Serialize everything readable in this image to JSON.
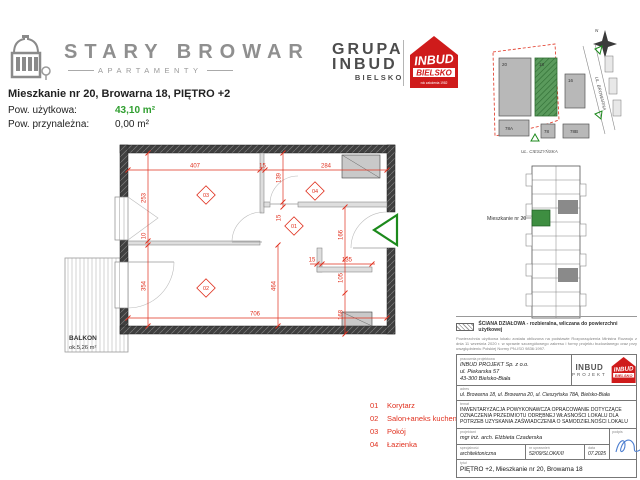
{
  "header": {
    "brand": "STARY BROWAR",
    "brand_sub": "APARTAMENTY",
    "title": "Mieszkanie nr 20, Browarna 18, PIĘTRO +2",
    "area_label": "Pow. użytkowa:",
    "area_value": "43,10 m²",
    "adj_label": "Pow. przynależna:",
    "adj_value": "0,00 m²"
  },
  "logos": {
    "grupa_line1": "GRUPA",
    "grupa_line2": "INBUD",
    "grupa_line3": "BIELSKO",
    "inbud_text": "INBUD",
    "inbud_sub": "BIELSKO",
    "inbud_tagline": "rok założenia 1982",
    "projekt_line1": "INBUD",
    "projekt_line2": "PROJEKT"
  },
  "site_plan": {
    "north": "N",
    "street_bottom": "UL. CIESZYŃSKA",
    "street_right": "UL. BROWARNA",
    "buildings": [
      "20",
      "18",
      "16",
      "78A",
      "78",
      "78B"
    ]
  },
  "overview": {
    "unit_label": "Mieszkanie nr 20"
  },
  "plan": {
    "balcony_label": "BALKON",
    "balcony_area": "ok.5,26 m²",
    "rooms": [
      {
        "id": "03",
        "x": 151,
        "y": 57
      },
      {
        "id": "04",
        "x": 260,
        "y": 53
      },
      {
        "id": "01",
        "x": 239,
        "y": 88
      },
      {
        "id": "02",
        "x": 151,
        "y": 150
      }
    ],
    "dims": [
      {
        "text": "407",
        "x": 140,
        "y": 29.5,
        "rot": 0
      },
      {
        "text": "15",
        "x": 207.5,
        "y": 29.5,
        "rot": 0
      },
      {
        "text": "284",
        "x": 271,
        "y": 29.5,
        "rot": 0
      },
      {
        "text": "253",
        "x": 90.5,
        "y": 60,
        "rot": -90
      },
      {
        "text": "10",
        "x": 90.5,
        "y": 98,
        "rot": -90
      },
      {
        "text": "354",
        "x": 90.5,
        "y": 148,
        "rot": -90
      },
      {
        "text": "139",
        "x": 225.5,
        "y": 40,
        "rot": -90
      },
      {
        "text": "15",
        "x": 225.5,
        "y": 80,
        "rot": -90
      },
      {
        "text": "166",
        "x": 287.5,
        "y": 97,
        "rot": -90
      },
      {
        "text": "105",
        "x": 287.5,
        "y": 140,
        "rot": -90
      },
      {
        "text": "168",
        "x": 287.5,
        "y": 177,
        "rot": -90
      },
      {
        "text": "15",
        "x": 257,
        "y": 123.5,
        "rot": 0
      },
      {
        "text": "135",
        "x": 292,
        "y": 123.5,
        "rot": 0
      },
      {
        "text": "464",
        "x": 220.5,
        "y": 148,
        "rot": -90
      },
      {
        "text": "706",
        "x": 200,
        "y": 177.5,
        "rot": 0
      }
    ]
  },
  "legend": {
    "items": [
      {
        "num": "01",
        "label": "Korytarz"
      },
      {
        "num": "02",
        "label": "Salon+aneks kuchenny"
      },
      {
        "num": "03",
        "label": "Pokój"
      },
      {
        "num": "04",
        "label": "Łazienka"
      }
    ]
  },
  "titleblock": {
    "wall_legend": "ŚCIANA DZIAŁOWA - rozbieralna, wliczana do powierzchni użytkowej",
    "fine_print": "Powierzchnia użytkowa lokalu została obliczona na podstawie Rozporządzenia Ministra Rozwoju z dnia 11 września 2020 r. w sprawie szczegółowego zakresu i formy projektu budowlanego oraz przy uwzględnieniu Polskiej Normy PN-ISO 9836:1997.",
    "office_label": "pracownia projektowa",
    "office_name": "INBUD PROJEKT Sp. z o.o.",
    "office_addr1": "ul. Piekarska 57",
    "office_addr2": "43-300 Bielsko-Biała",
    "address_label": "adres",
    "address": "ul. Browarna 18, ul. Browarna 20, ul. Cieszyńska 78A,  Bielsko-Biała",
    "subject_label": "temat",
    "subject": "INWENTARYZACJA POWYKONAWCZA OPRACOWANIE DOTYCZĄCE OZNACZENIA PRZEDMIOTU ODRĘBNEJ WŁASNOŚCI LOKALU DLA POTRZEB UZYSKANIA ZAŚWIADCZENIA O SAMODZIELNOŚCI LOKALU",
    "architect_label": "projektant",
    "architect": "mgr inż. arch. Elżbieta Czaderska",
    "specialty_label": "specjalność",
    "specialty": "architektoniczna",
    "license_label": "nr uprawnień",
    "license": "52/09/SLOKK/II",
    "date_label": "data",
    "date": "07.2025",
    "signature_label": "podpis",
    "drawing_label": "tytuł",
    "drawing_title": "PIĘTRO +2, Mieszkanie nr 20, Browarna 18"
  }
}
